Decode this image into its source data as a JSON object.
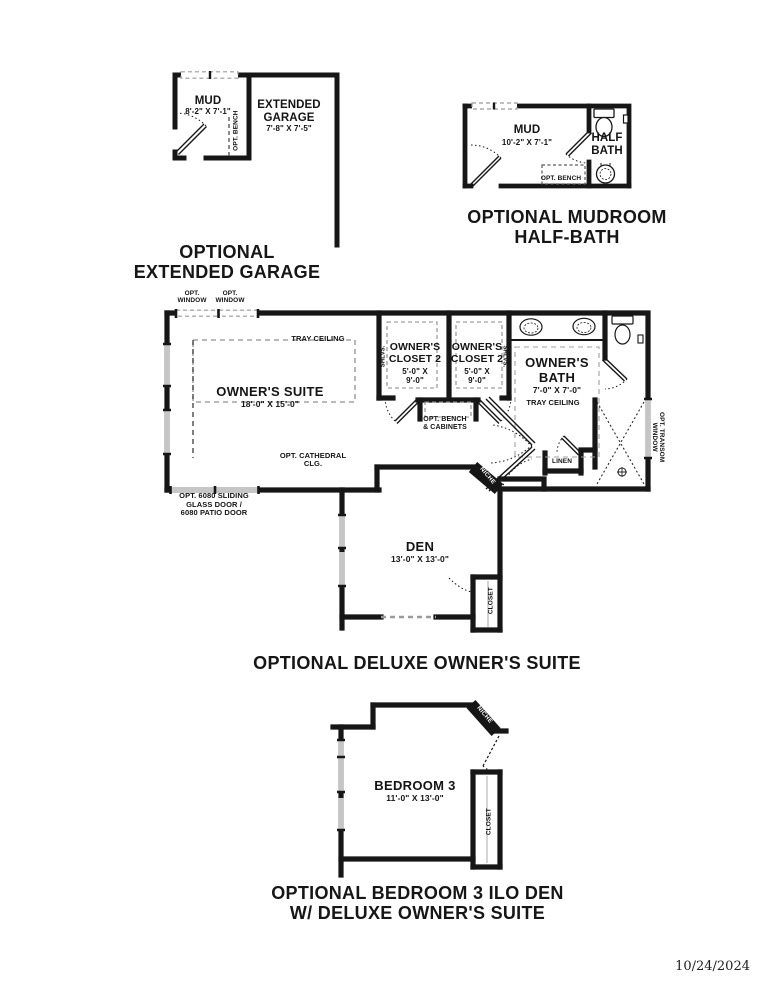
{
  "document": {
    "date": "10/24/2024"
  },
  "colors": {
    "wall": "#161616",
    "window_gray": "#c6c6c6",
    "dash_gray": "#909090",
    "background": "#ffffff"
  },
  "plans": {
    "extended_garage": {
      "title_lines": [
        "OPTIONAL",
        "EXTENDED GARAGE"
      ],
      "rooms": {
        "mud": {
          "name": "MUD",
          "dims": "8'-2\" X 7'-1\""
        },
        "garage": {
          "name": "EXTENDED GARAGE",
          "dims": "7'-8\" X 7'-5\""
        }
      },
      "labels": {
        "opt_bench": "OPT. BENCH"
      },
      "fixtures": []
    },
    "mudroom_half_bath": {
      "title_lines": [
        "OPTIONAL MUDROOM",
        "HALF-BATH"
      ],
      "rooms": {
        "mud": {
          "name": "MUD",
          "dims": "10'-2\" X 7'-1\""
        },
        "half_bath": {
          "name": "HALF BATH"
        }
      },
      "labels": {
        "opt_bench": "OPT. BENCH"
      },
      "fixtures": [
        "toilet-icon",
        "sink-icon",
        "toilet-paper-icon"
      ]
    },
    "deluxe_owners_suite": {
      "title_lines": [
        "OPTIONAL DELUXE OWNER'S SUITE"
      ],
      "rooms": {
        "owners_suite": {
          "name": "OWNER'S SUITE",
          "dims": "18'-0\" X 15'-0\""
        },
        "owners_closet_left": {
          "name": "OWNER'S CLOSET 2",
          "dims": "5'-0\" X 9'-0\""
        },
        "owners_closet_right": {
          "name": "OWNER'S CLOSET 2",
          "dims": "5'-0\" X 9'-0\""
        },
        "owners_bath": {
          "name": "OWNER'S BATH",
          "dims": "7'-0\" X 7'-0\""
        },
        "den": {
          "name": "DEN",
          "dims": "13'-0\" X 13'-0\""
        }
      },
      "labels": {
        "opt_window": "OPT. WINDOW",
        "tray_ceiling_suite": "TRAY CEILING",
        "opt_cathedral_clg": "OPT. CATHEDRAL CLG.",
        "sliding_door_lines": [
          "OPT. 6080 SLIDING",
          "GLASS DOOR /",
          "6080 PATIO DOOR"
        ],
        "shlvs": "SHLVS.",
        "opt_bench_cabinets": "OPT. BENCH & CABINETS",
        "tray_ceiling_bath": "TRAY CEILING",
        "linen": "LINEN",
        "niche": "NICHE",
        "opt_transom_window": "OPT. TRANSOM WINDOW",
        "closet": "CLOSET"
      },
      "fixtures": [
        "sink-icon",
        "sink-icon",
        "toilet-icon",
        "toilet-paper-icon",
        "shower-drain-icon"
      ]
    },
    "bedroom3_ilo_den": {
      "title_lines": [
        "OPTIONAL BEDROOM 3 ILO DEN",
        "W/ DELUXE OWNER'S SUITE"
      ],
      "rooms": {
        "bedroom3": {
          "name": "BEDROOM 3",
          "dims": "11'-0\" X 13'-0\""
        }
      },
      "labels": {
        "closet": "CLOSET",
        "niche": "NICHE"
      },
      "fixtures": []
    }
  }
}
